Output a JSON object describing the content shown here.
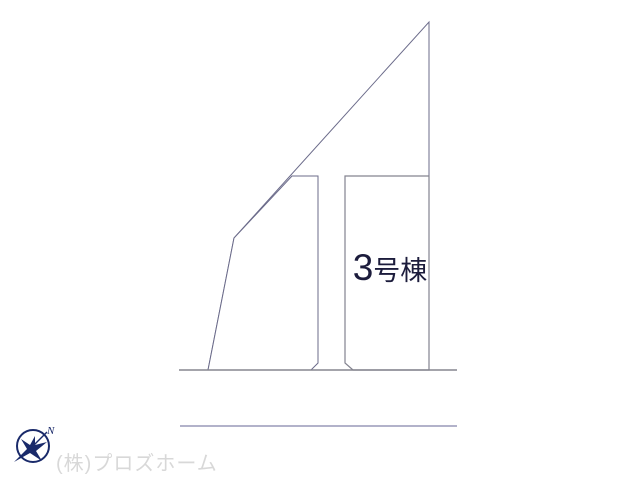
{
  "diagram": {
    "lot_label": {
      "number": "3",
      "suffix": "号棟"
    },
    "company_watermark": "(株)プロズホーム",
    "compass": {
      "label": "N"
    },
    "colors": {
      "background": "#ffffff",
      "lot_highlight_fill": "#f8dc9a",
      "lot_outline": "#6b6b8a",
      "road_line_primary": "#85858f",
      "road_line_secondary": "#9898b8",
      "lot_label_text": "#1c1c3c",
      "watermark_text": "#d8d8d8",
      "compass_color": "#1a2a6a"
    }
  }
}
